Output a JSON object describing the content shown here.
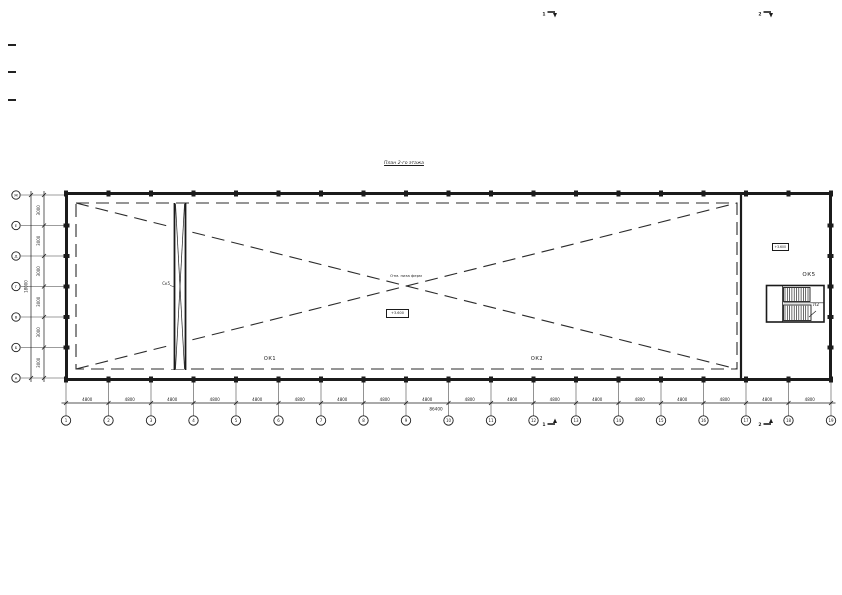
{
  "page": {
    "title": "План 2-го этажа"
  },
  "axes": {
    "bottom": {
      "labels": [
        "1",
        "2",
        "3",
        "4",
        "5",
        "6",
        "7",
        "8",
        "9",
        "10",
        "11",
        "12",
        "13",
        "14",
        "15",
        "16",
        "17",
        "18",
        "19"
      ],
      "dims": [
        "4800",
        "4800",
        "4800",
        "4800",
        "4800",
        "4800",
        "4800",
        "4800",
        "4800",
        "4800",
        "4800",
        "4800",
        "4800",
        "4800",
        "4800",
        "4800",
        "4800",
        "4800"
      ],
      "total": "86400"
    },
    "left": {
      "labels": [
        "Ж",
        "Е",
        "Д",
        "Г",
        "В",
        "Б",
        "А"
      ],
      "dims": [
        "3000",
        "3000",
        "3000",
        "3000",
        "3000",
        "3000"
      ],
      "total": "18000"
    }
  },
  "marks": {
    "ok1": "ОК1",
    "ok2": "ОК2",
    "ok5": "ОК5",
    "stair": "Л2",
    "shaft": "Ск5",
    "note_center": "Отм. низа ферм",
    "elev_center": "+3.600",
    "elev_room": "+3.600"
  },
  "sections": {
    "s1": "1",
    "s2": "2"
  },
  "colors": {
    "ink": "#1b1b1b",
    "thin": "#3a3a3a",
    "dash": "#2b2b2b"
  }
}
